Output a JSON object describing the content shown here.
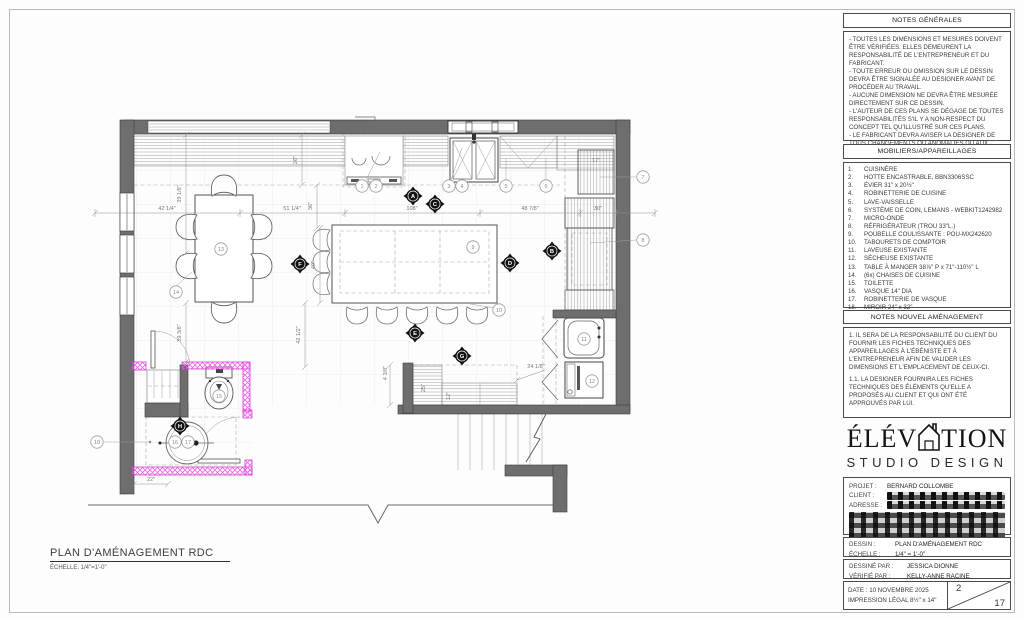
{
  "sheet": {
    "notes_generales": {
      "title": "NOTES GÉNÉRALES",
      "body": "- TOUTES LES DIMENSIONS ET MESURES DOIVENT ÊTRE VÉRIFIÉES. ELLES DEMEURENT LA RESPONSABILITÉ DE L'ENTREPRENEUR ET DU FABRICANT.\n- TOUTE ERREUR OU OMISSION SUR LE DESSIN DEVRA ÊTRE SIGNALÉE AU DESIGNER AVANT DE PROCÉDER AU TRAVAIL.\n- AUCUNE DIMENSION NE DEVRA ÊTRE MESURÉE DIRECTEMENT SUR CE DESSIN.\n- L'AUTEUR DE CES PLANS SE DÉGAGE DE TOUTES RESPONSABILITÉS S'IL Y A NON-RESPECT DU CONCEPT TEL QU'ILLUSTRÉ SUR CES PLANS.\n- LE FABRICANT DEVRA AVISER LA DESIGNER DE TOUS CHANGEMENTS OU ANOMALIES DU AUX PLANS OU AUX MESURES FINALES."
    },
    "mobiliers": {
      "title": "MOBILIERS/APPAREILLAGES",
      "items": [
        {
          "n": "1.",
          "t": "CUISINÈRE"
        },
        {
          "n": "2.",
          "t": "HOTTE ENCASTRABLE, BBN3306SSC"
        },
        {
          "n": "3.",
          "t": "ÉVIER 31\" x 20½\""
        },
        {
          "n": "4.",
          "t": "ROBINETTERIE DE CUISINE"
        },
        {
          "n": "5.",
          "t": "LAVE-VAISSELLE"
        },
        {
          "n": "6.",
          "t": "SYSTÈME DE COIN, LEMANS - WEBKIT1242982"
        },
        {
          "n": "7.",
          "t": "MICRO-ONDE"
        },
        {
          "n": "8.",
          "t": "RÉFRIGÉRATEUR (TROU 33\"L.)"
        },
        {
          "n": "9.",
          "t": "POUBELLE COULISSANTE : POU-MX242620"
        },
        {
          "n": "10.",
          "t": "TABOURETS DE COMPTOIR"
        },
        {
          "n": "11.",
          "t": "LAVEUSE EXISTANTE"
        },
        {
          "n": "12.",
          "t": "SÉCHEUSE EXISTANTE"
        },
        {
          "n": "13.",
          "t": "TABLE À MANGER 38⅞\" P x 71\"-110½\" L"
        },
        {
          "n": "14.",
          "t": "(6x) CHAISES DE CUISINE"
        },
        {
          "n": "15.",
          "t": "TOILETTE"
        },
        {
          "n": "16.",
          "t": "VASQUE 14\" DIA"
        },
        {
          "n": "17.",
          "t": "ROBINETTERIE DE VASQUE"
        },
        {
          "n": "18.",
          "t": "MIROIR 24\" x 32\""
        }
      ]
    },
    "notes_nouvel": {
      "title": "NOTES NOUVEL AMÉNAGEMENT",
      "p1": "1. IL SERA DE LA RESPONSABILITÉ DU CLIENT DU FOURNIR LES FICHES TECHNIQUES DES APPAREILLAGES À L'ÉBÉNISTE ET À L'ENTREPRENEUR AFIN DE VALIDER LES DIMENSIONS ET L'EMPLACEMENT DE CEUX-CI.",
      "p2": "1.1. LA DESIGNER FOURNIRA LES FICHES TECHNIQUES DES ÉLÉMENTS QU'ELLE A PROPOSÉS AU CLIENT ET QUI ONT ÉTÉ APPROUVÉS PAR LUI."
    },
    "logo": {
      "left": "ÉLÉV",
      "right": "TION",
      "subtitle": "STUDIO DESIGN"
    },
    "project": {
      "projet_label": "PROJET :",
      "projet_value": "BERNARD COLLOMBE",
      "client_label": "CLIENT :",
      "adresse_label": "ADRESSE :"
    },
    "dessin": {
      "label": "DESSIN :",
      "value": "PLAN D'AMÉNAGEMENT RDC",
      "echelle_label": "ÉCHELLE :",
      "echelle_value": "1/4\" = 1'-0\""
    },
    "credits": {
      "dessine_label": "DESSINÉ PAR :",
      "dessine_value": "JESSICA DIONNE",
      "verifie_label": "VÉRIFIÉ PAR :",
      "verifie_value": "KELLY-ANNE RACINE"
    },
    "footer": {
      "date": "DATE : 10 NOVEMBRE 2025",
      "impression": "IMPRESSION LÉGAL 8½\" x 14\"",
      "page": "2",
      "total": "17"
    }
  },
  "plan_title": {
    "title": "PLAN D'AMÉNAGEMENT RDC",
    "scale": "ÉCHELLE: 1/4\"=1'-0\""
  },
  "plan": {
    "dims": [
      "42 1/4\"",
      "51 1/4\"",
      "108\"",
      "48 7/8\"",
      "30\"",
      "17\"",
      "39 1/8\"",
      "26\"",
      "36\"",
      "49\"",
      "42 1/2\"",
      "39 3/8\"",
      "22\"",
      "24 1/8\"",
      "25\"",
      "12\"",
      "4 3/8\""
    ],
    "callouts": [
      "1",
      "2",
      "3",
      "4",
      "5",
      "6",
      "7",
      "8",
      "9",
      "10",
      "11",
      "12",
      "13",
      "14",
      "15",
      "16",
      "17",
      "18"
    ],
    "markers": [
      "A",
      "B",
      "C",
      "D",
      "E",
      "F",
      "G",
      "H"
    ]
  }
}
